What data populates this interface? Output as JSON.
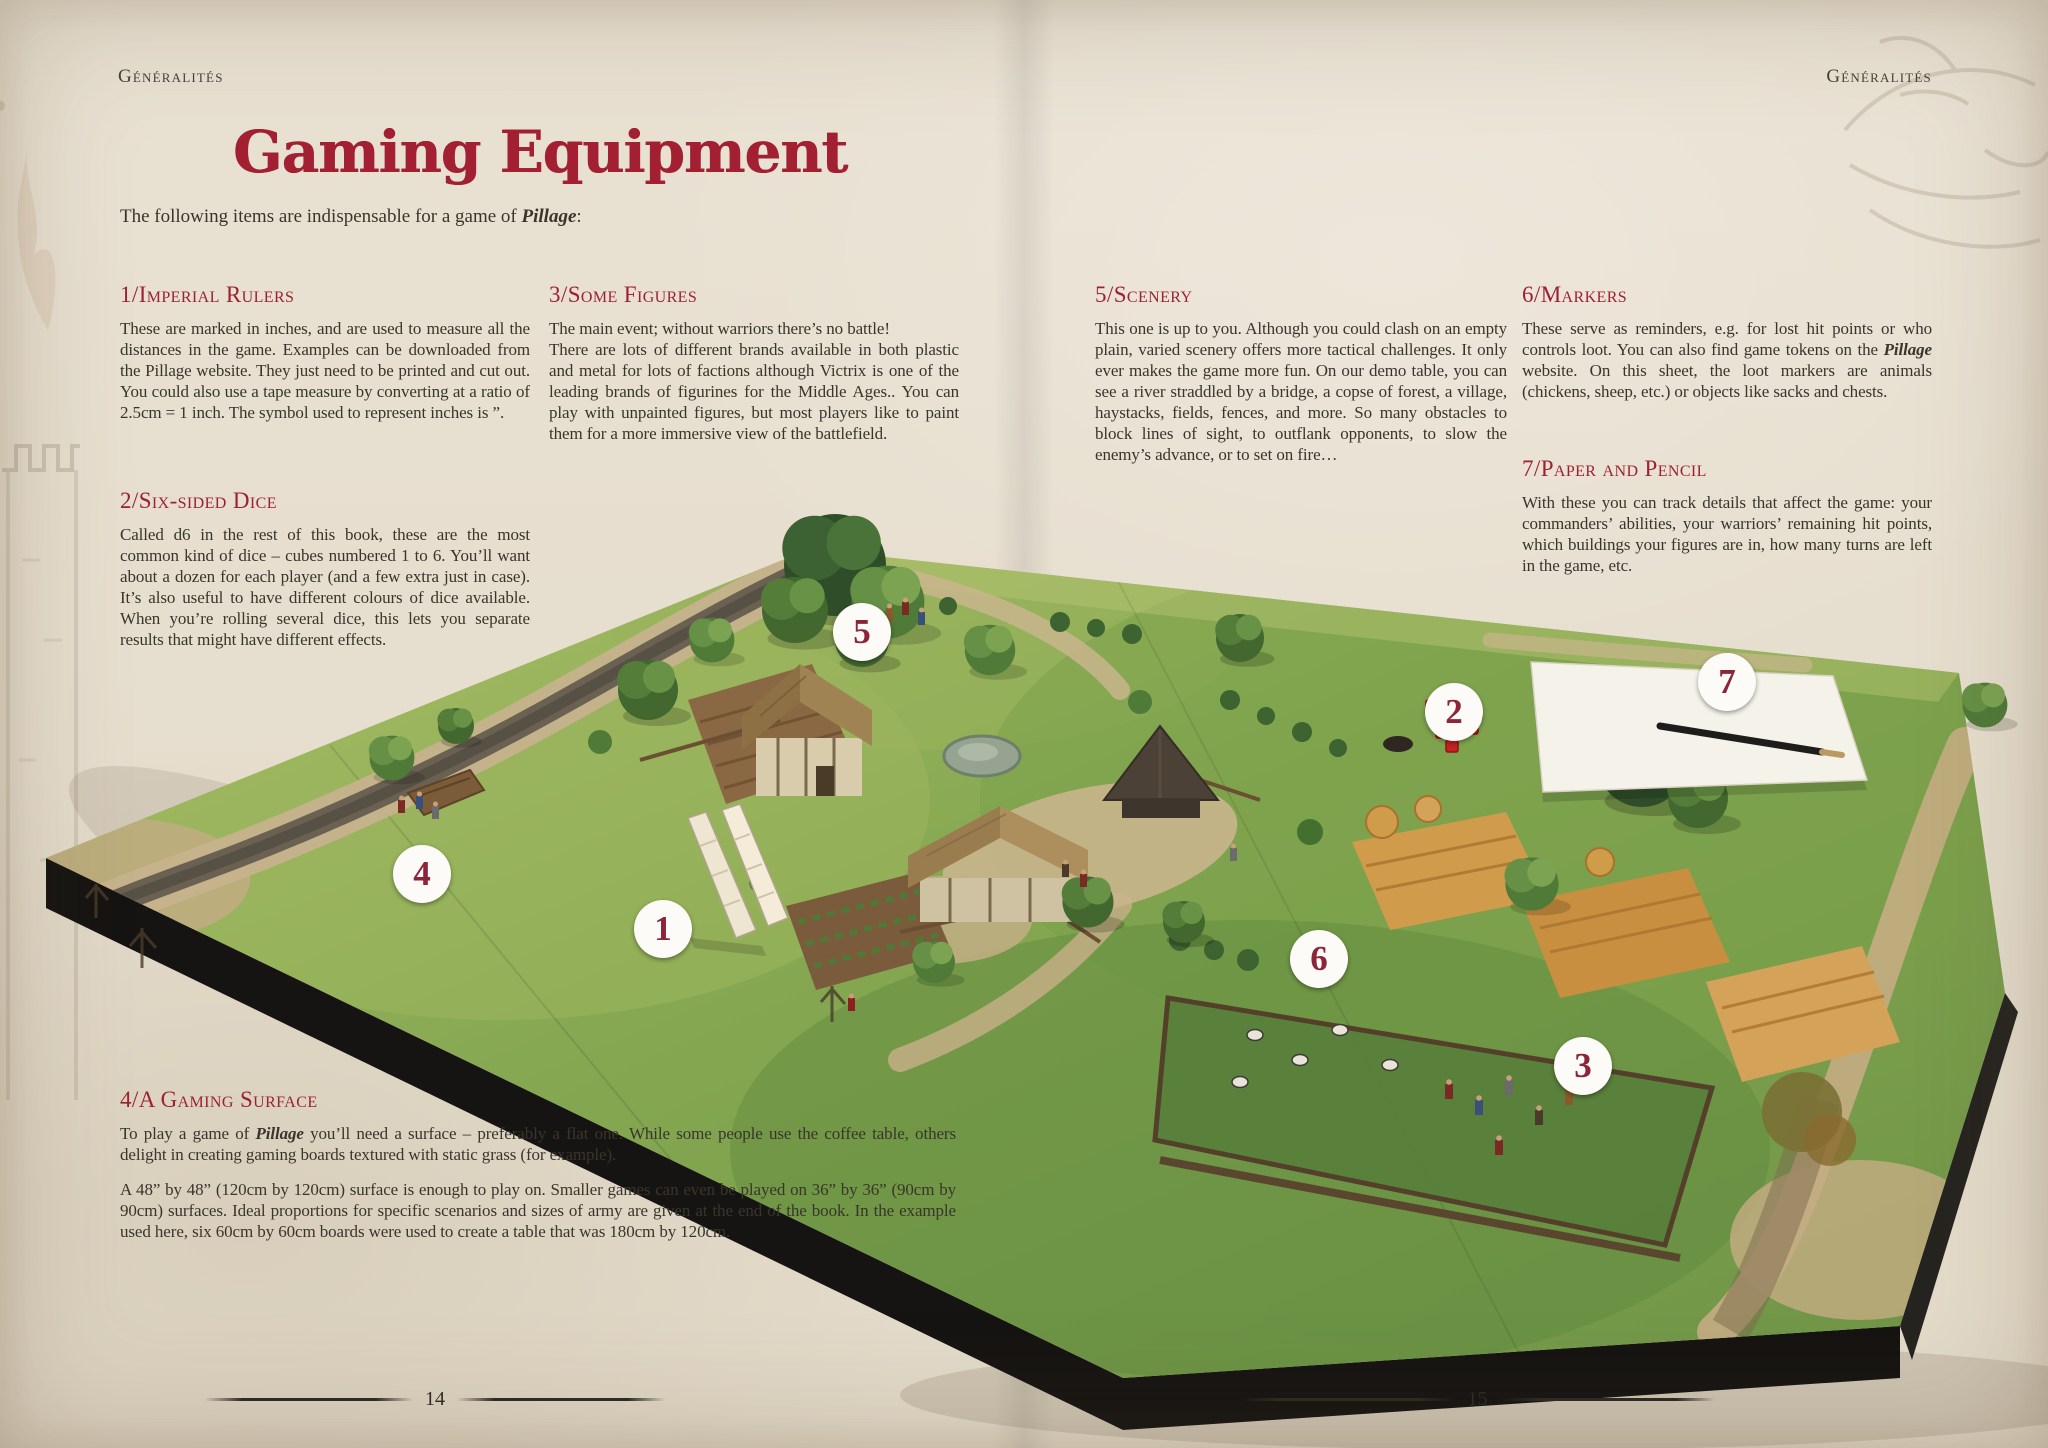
{
  "header": {
    "left": "Généralités",
    "right": "Généralités"
  },
  "title": "Gaming Equipment",
  "intro": {
    "pre": "The following items are indispensable for a game of ",
    "em": "Pillage",
    "post": ":"
  },
  "sections": {
    "s1": {
      "heading": "1/Imperial Rulers",
      "body": "These are marked in inches, and are used to measure all the distances in the game. Examples can be downloaded from the Pillage website. They just need to be printed and cut out. You could also use a tape measure by converting at a ratio of 2.5cm = 1 inch. The symbol used to represent inches is ”."
    },
    "s2": {
      "heading": "2/Six-sided Dice",
      "body": "Called d6 in the rest of this book, these are the most common kind of dice – cubes numbered 1 to 6. You’ll want about a dozen for each player (and a few extra just in case). It’s also useful to have different colours of dice available. When you’re rolling several dice, this lets you separate results that might have different effects."
    },
    "s3": {
      "heading": "3/Some Figures",
      "line1": "The main event; without warriors there’s no battle!",
      "body": "There are lots of different brands available in both plastic and metal for lots of factions although Victrix is one of the leading brands of figurines for the Middle Ages.. You can play with unpainted figures, but most players like to paint them for a more immersive view of the battlefield."
    },
    "s4": {
      "heading": "4/A Gaming Surface",
      "p1_pre": "To play a game of ",
      "p1_em": "Pillage",
      "p1_post": " you’ll need a surface – preferably a flat one. While some people use the coffee table, others delight in creating gaming boards textured with static grass (for example).",
      "p2": "A 48” by 48” (120cm by 120cm) surface is enough to play on. Smaller games can even be played on 36” by 36” (90cm by 90cm) surfaces. Ideal proportions for specific scenarios and sizes of army are given at the end of the book. In the example used here, six 60cm by 60cm boards were used to create a table that was 180cm by 120cm."
    },
    "s5": {
      "heading": "5/Scenery",
      "body": "This one is up to you. Although you could clash on an empty plain, varied scenery offers more tactical challenges. It only ever makes the game more fun. On our demo table, you can see a river straddled by a bridge, a copse of forest, a village, haystacks, fields, fences, and more. So many obstacles to block lines of sight, to outflank opponents, to slow the enemy’s advance, or to set on fire…"
    },
    "s6": {
      "heading": "6/Markers",
      "pre": "These serve as reminders, e.g. for lost hit points or who controls loot. You can also find game tokens on the ",
      "em": "Pillage",
      "post": " website. On this sheet, the loot markers are animals (chickens, sheep, etc.) or objects like sacks and chests."
    },
    "s7": {
      "heading": "7/Paper and Pencil",
      "body": "With these you can track details that affect the game: your commanders’ abilities, your warriors’ remaining hit points, which buildings your figures are in, how many turns are left in the game, etc."
    }
  },
  "footer": {
    "left_page": "14",
    "right_page": "15"
  },
  "photo": {
    "markers": [
      {
        "n": "1"
      },
      {
        "n": "2"
      },
      {
        "n": "3"
      },
      {
        "n": "4"
      },
      {
        "n": "5"
      },
      {
        "n": "6"
      },
      {
        "n": "7"
      }
    ]
  }
}
